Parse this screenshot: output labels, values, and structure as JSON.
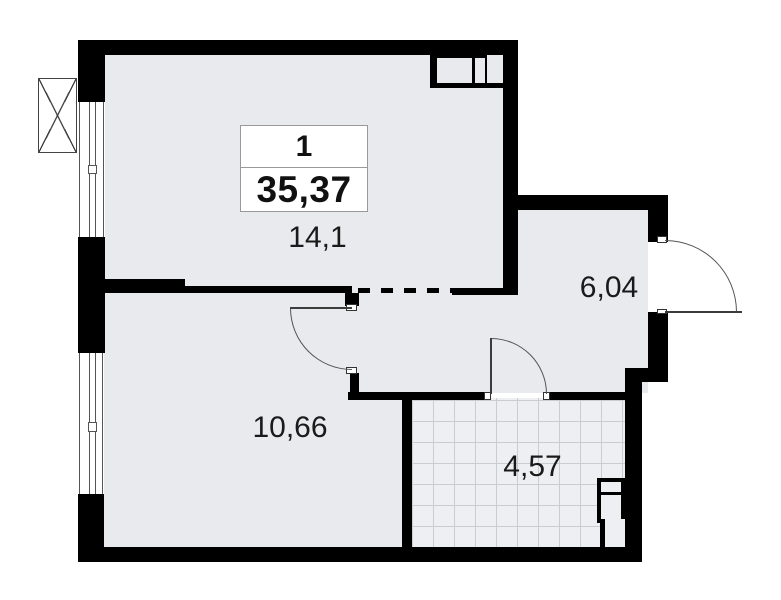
{
  "plan": {
    "unit_box": {
      "number": "1",
      "total_area": "35,37"
    },
    "rooms": [
      {
        "id": "living-room",
        "area": "14,1"
      },
      {
        "id": "hallway",
        "area": "6,04"
      },
      {
        "id": "bedroom",
        "area": "10,66"
      },
      {
        "id": "bathroom",
        "area": "4,57"
      }
    ],
    "symbols": [
      "window",
      "door-swing-arc",
      "entrance-door",
      "dashed-partition",
      "ventilation-block",
      "plumbing-shaft",
      "tiled-floor",
      "crossed-box-unit"
    ],
    "colors": {
      "wall": "#000000",
      "floor": "#e8eaed",
      "tile_floor": "#edeff2",
      "tile_line": "#c9cdd2",
      "thin_line": "#555555",
      "text": "#1a1a1a",
      "box_border": "#999999",
      "background": "#ffffff"
    }
  }
}
